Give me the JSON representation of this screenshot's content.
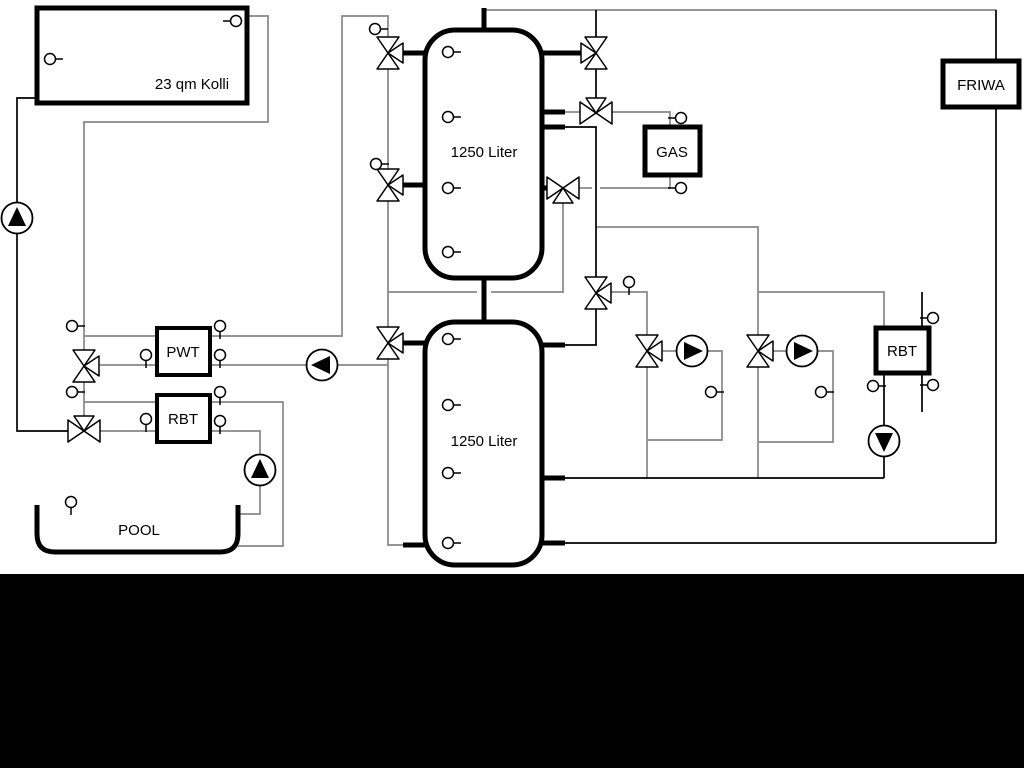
{
  "diagram": {
    "collector": {
      "label": "23 qm Kolli"
    },
    "tank_top": {
      "label": "1250 Liter"
    },
    "tank_bottom": {
      "label": "1250 Liter"
    },
    "pwt": {
      "label": "PWT"
    },
    "rbt_left": {
      "label": "RBT"
    },
    "rbt_right": {
      "label": "RBT"
    },
    "gas": {
      "label": "GAS"
    },
    "friwa": {
      "label": "FRIWA"
    },
    "pool": {
      "label": "POOL"
    }
  },
  "colors": {
    "pipe_gray": "#878787",
    "pipe_black": "#000000",
    "background": "#ffffff",
    "footer_band": "#000000"
  }
}
